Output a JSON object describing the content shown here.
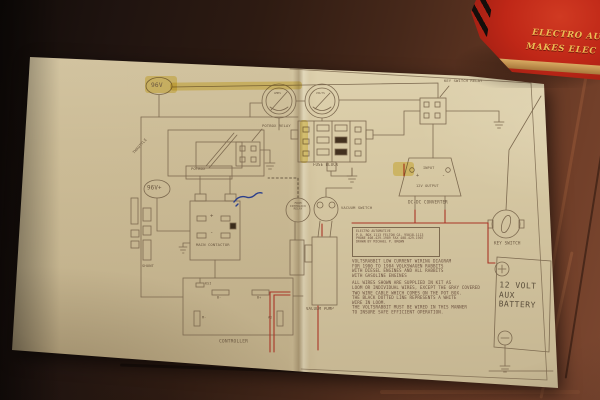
{
  "scene": {
    "book": {
      "title_line1": "ELECTRO AU",
      "title_line2": "MAKES ELEC",
      "cover_color": "#bf2717",
      "text_color": "#edbd55"
    },
    "handwriting_color": "#2b3f8c"
  },
  "diagram": {
    "badge_top": "96V",
    "badge_mid": "96V+",
    "gauge_left_label": "AMPS",
    "gauge_right_label": "VOLTS",
    "labels": {
      "potbox_relay": "POTBOX RELAY",
      "potbox": "POTBOX",
      "throttle": "THROTTLE",
      "fuse_block": "FUSE BLOCK",
      "key_switch_relay": "KEY SWITCH RELAY",
      "dcdc_input": "INPUT",
      "dcdc_output": "12V OUTPUT",
      "dcdc_converter": "DC-DC CONVERTER",
      "key_switch": "KEY SWITCH",
      "main_contactor": "MAIN CONTACTOR",
      "shunt": "SHUNT",
      "controller": "CONTROLLER",
      "vacuum_switch": "VACUUM SWITCH",
      "vacuum_pump": "VACUUM PUMP",
      "interlock_l1": "FROM",
      "interlock_l2": "INTERLOCK",
      "interlock_l3": "RELAY",
      "plus": "+",
      "minus": "-"
    },
    "controller_terminals": {
      "ksi": "KSI",
      "b_minus": "B-",
      "b_plus": "B+",
      "m_minus": "M-",
      "a2": "A2"
    },
    "battery": {
      "l1": "12 VOLT",
      "l2": "AUX",
      "l3": "BATTERY"
    },
    "info_box": {
      "l1": "ELECTRO AUTOMOTIVE",
      "l2": "P.O. BOX 1113 FELTON CA. 95018-1113",
      "l3": "PHONE 408-429-1989 FAX 408-429-1907",
      "l4": "DRAWN BY MICHAEL P. BROWN"
    },
    "notes": {
      "l1": "VOLTSRABBIT LOW CURRENT WIRING DIAGRAM",
      "l2": "FOR 1980 TO 1984 VOLKSWAGEN RABBITS",
      "l3": "WITH DIESEL ENGINES AND ALL RABBITS",
      "l4": "WITH GASOLINE ENGINES",
      "l5": "ALL WIRES SHOWN ARE SUPPLIED IN KIT AS",
      "l6": "LOOM OR INDIVIDUAL WIRES, EXCEPT THE GRAY COVERED",
      "l7": "TWO WIRE CABLE WHICH COMES ON THE POT BOX.",
      "l8": "THE BLACK DOTTED LINE REPRESENTS A WHITE",
      "l9": "WIRE IN LOOM.",
      "l10": "THE VOLTSRABBIT MUST BE WIRED IN THIS MANNER",
      "l11": "TO INSURE SAFE EFFICIENT OPERATION."
    },
    "colors": {
      "line": "#7d6a50",
      "red_wire": "#a93526",
      "highlight": "#e8cd3c",
      "paper": "#d9cba6"
    }
  }
}
